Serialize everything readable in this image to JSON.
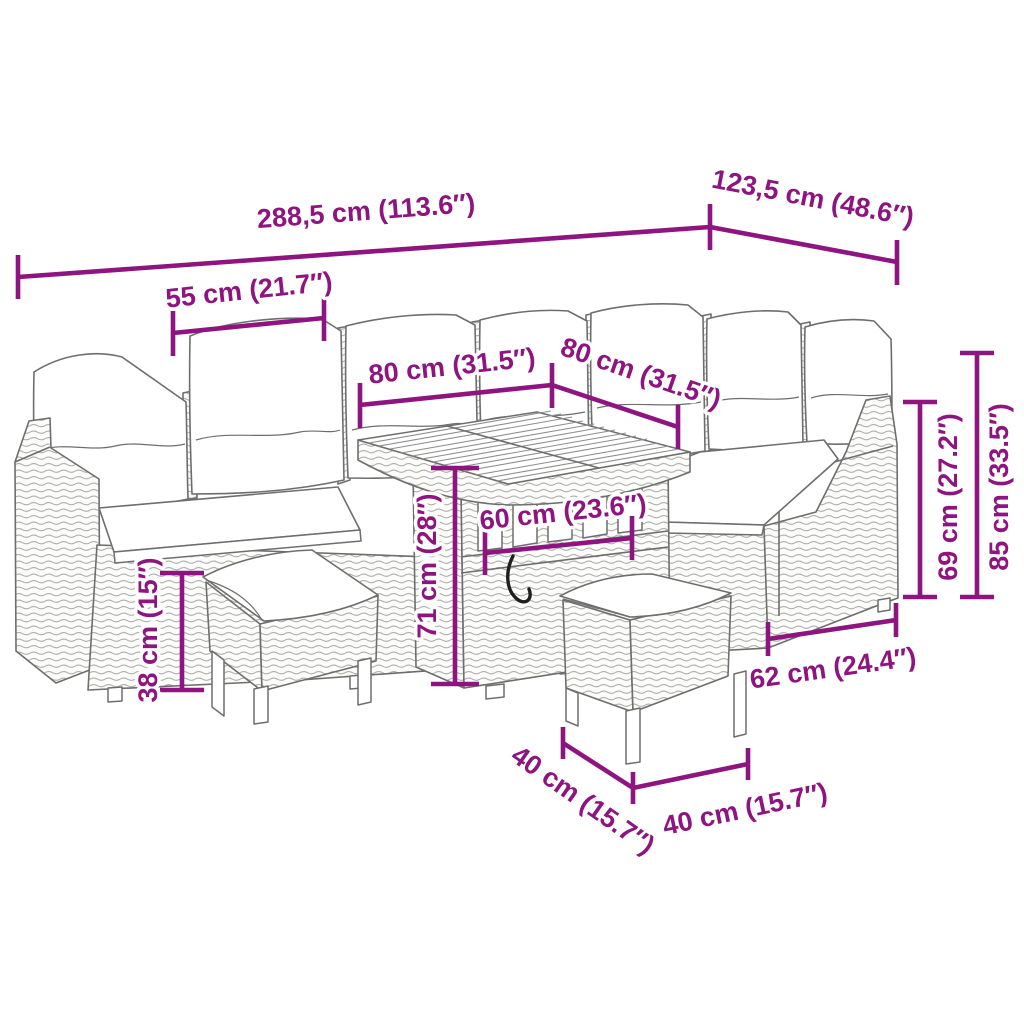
{
  "diagram": {
    "type": "product-dimension-diagram",
    "subject": "rattan garden lounge set with corner sofa, cube table and two stools",
    "colors": {
      "dimension": "#8E1480",
      "furniture_outline": "#6e6e6e",
      "background": "#ffffff"
    },
    "measurements": {
      "total_width": "288,5 cm (113.6″)",
      "total_depth": "123,5 cm (48.6″)",
      "cushion_width": "55 cm (21.7″)",
      "table_length": "80 cm (31.5″)",
      "table_depth": "80 cm (31.5″)",
      "backrest_height": "69 cm (27.2″)",
      "overall_height": "85 cm (33.5″)",
      "table_height": "71 cm (28″)",
      "shelf_width": "60 cm (23.6″)",
      "stool_height": "38 cm (15″)",
      "seat_depth": "62 cm (24.4″)",
      "stool_width": "40 cm (15.7″)",
      "stool_depth": "40 cm (15.7″)"
    }
  }
}
